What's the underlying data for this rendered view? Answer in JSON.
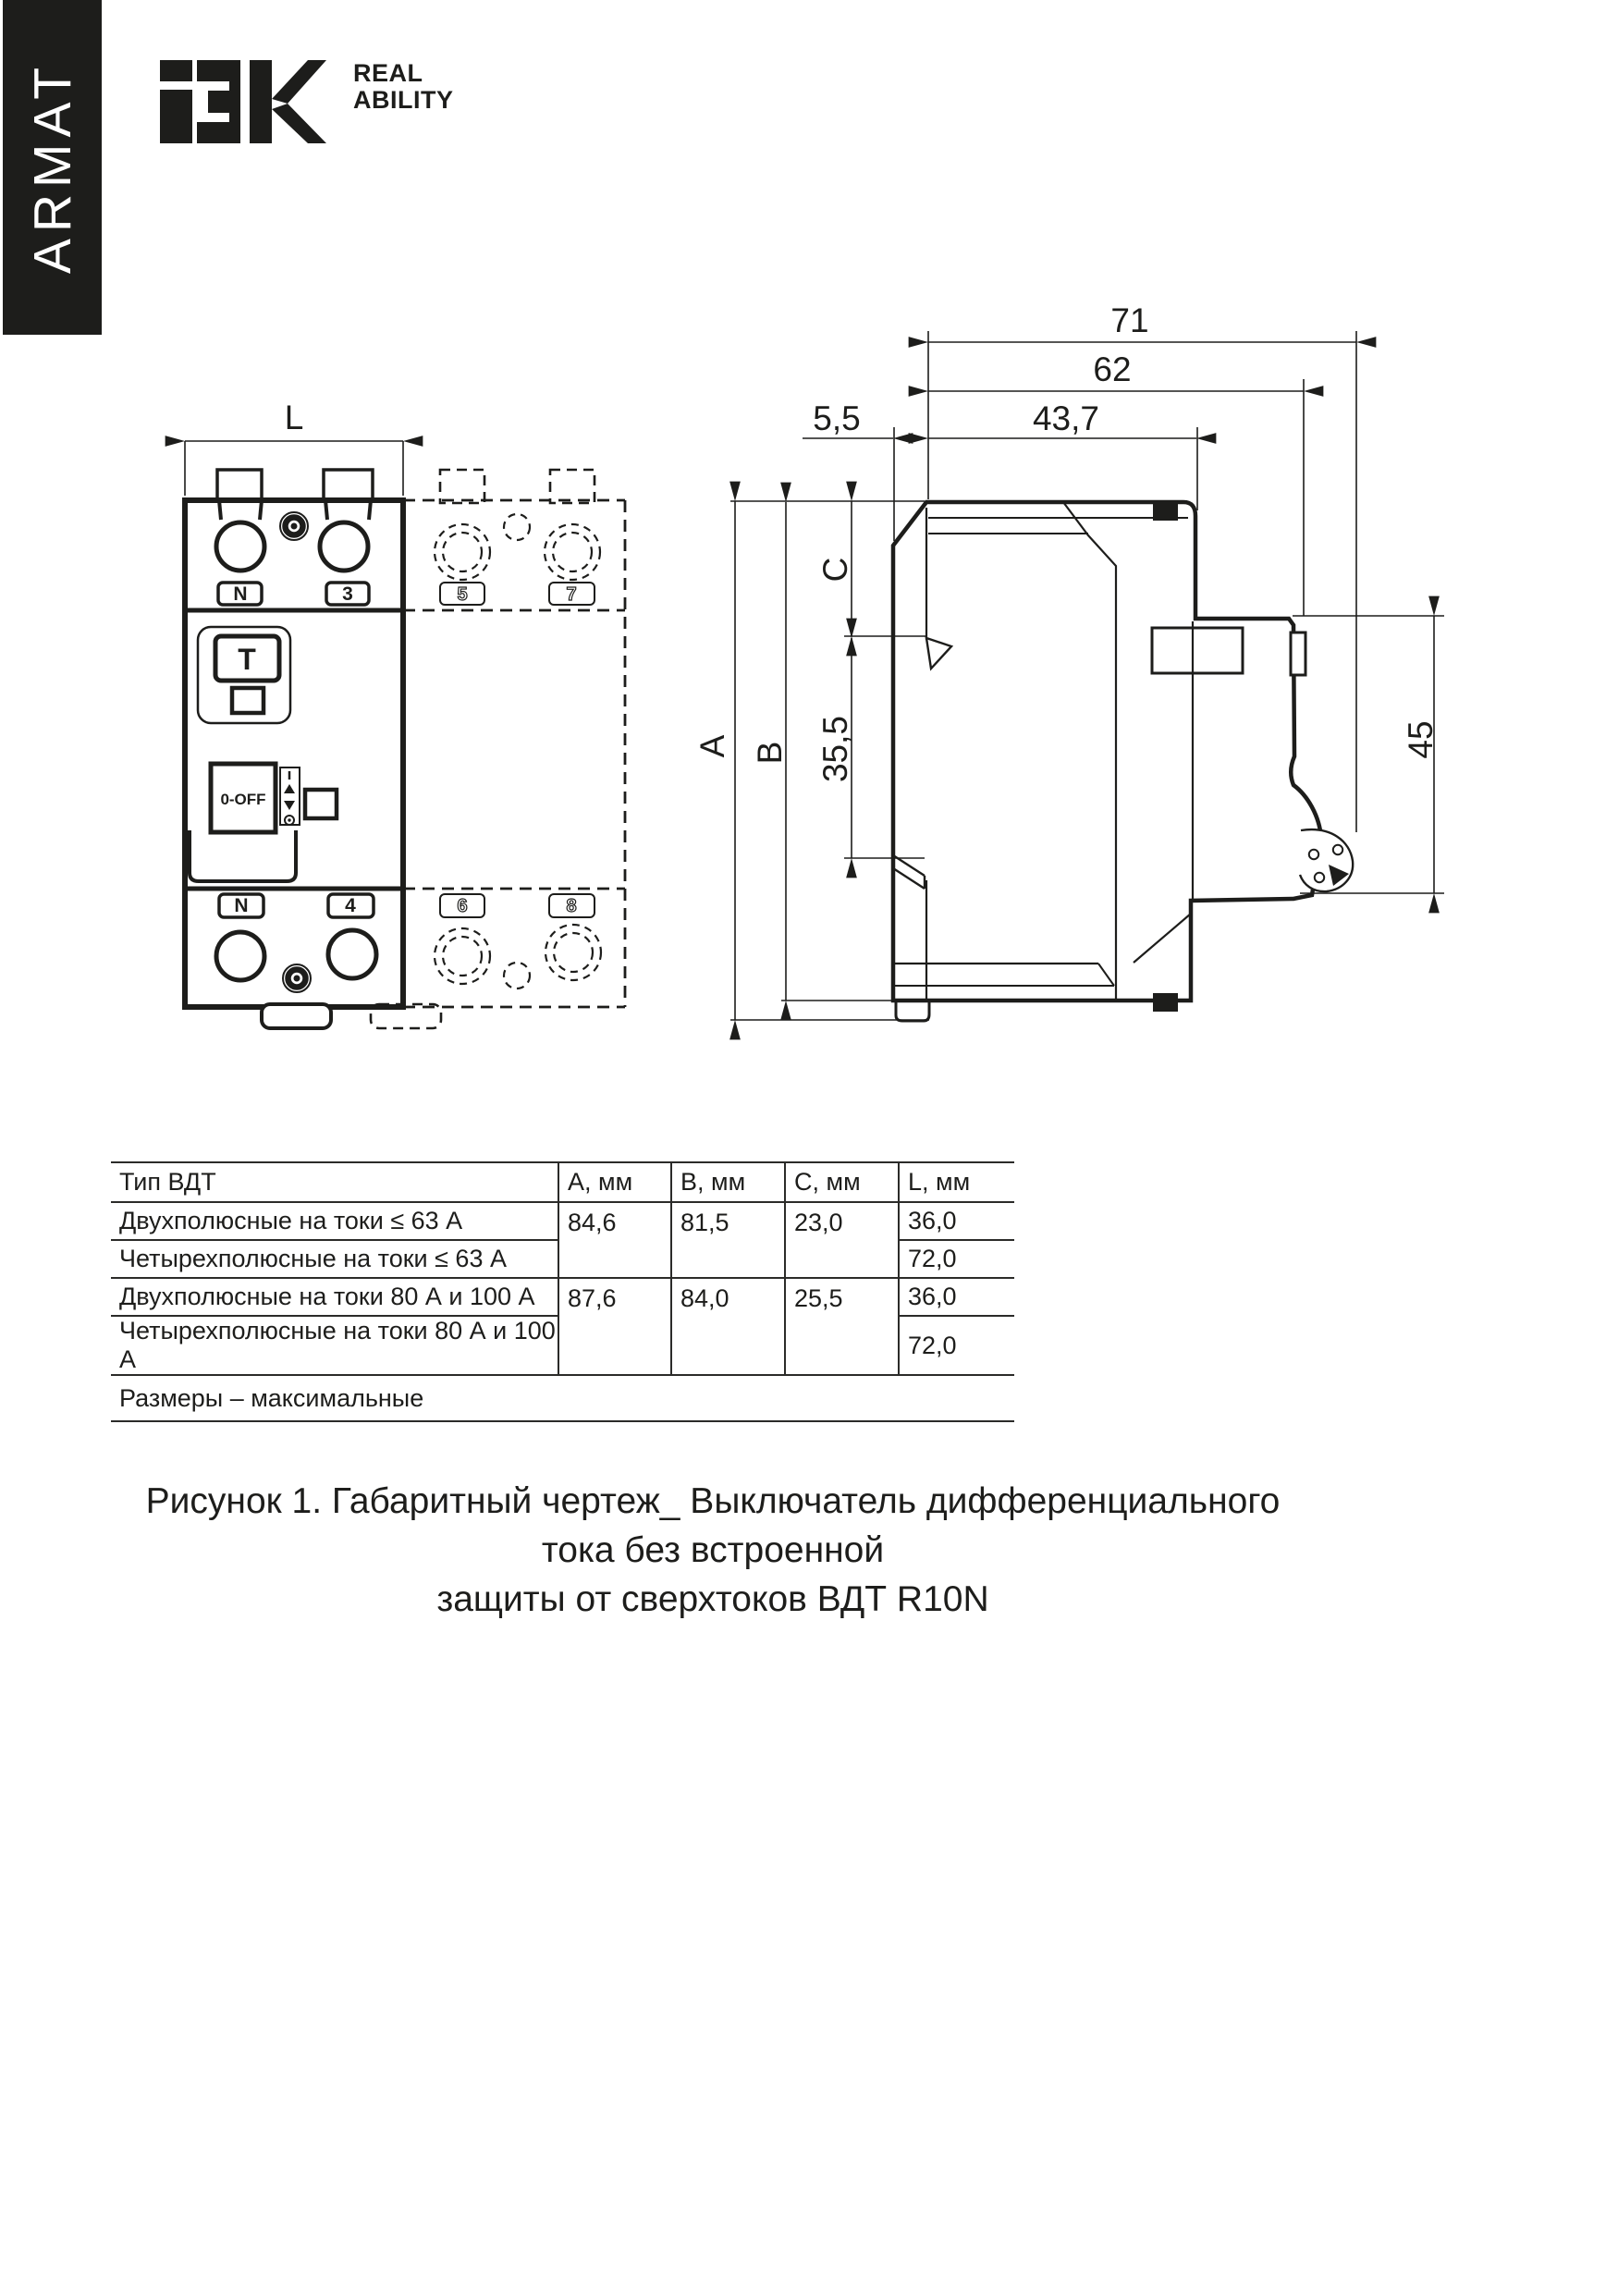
{
  "brand": {
    "sidebar_text": "ARMAT",
    "logo_name": "IEK",
    "tagline_line1": "REAL",
    "tagline_line2": "ABILITY"
  },
  "drawing": {
    "front_view": {
      "dim_width": "L",
      "top_terminal_labels": [
        "N",
        "3",
        "5",
        "7"
      ],
      "bottom_terminal_labels": [
        "N",
        "4",
        "6",
        "8"
      ],
      "test_button_label": "T",
      "switch_label": "0-OFF"
    },
    "side_view": {
      "dim_depth_total": "71",
      "dim_depth_body": "62",
      "dim_rail_offset": "5,5",
      "dim_depth_front": "43,7",
      "dim_height_a": "A",
      "dim_height_b": "B",
      "dim_height_c": "C",
      "dim_rail_channel": "35,5",
      "dim_front_height": "45"
    }
  },
  "table": {
    "headers": [
      "Тип ВДТ",
      "А, мм",
      "В, мм",
      "С, мм",
      "L, мм"
    ],
    "rows": [
      {
        "type": "Двухполюсные на токи ≤ 63 А",
        "a": "84,6",
        "b": "81,5",
        "c": "23,0",
        "l": "36,0"
      },
      {
        "type": "Четырехполюсные на токи ≤ 63 А",
        "l": "72,0"
      },
      {
        "type": "Двухполюсные на токи 80 А и 100 А",
        "a": "87,6",
        "b": "84,0",
        "c": "25,5",
        "l": "36,0"
      },
      {
        "type": "Четырехполюсные на токи 80 А и 100 А",
        "l": "72,0"
      }
    ],
    "footnote": "Размеры – максимальные"
  },
  "caption": {
    "line1": "Рисунок 1. Габаритный чертеж_ Выключатель дифференциального тока без встроенной",
    "line2": "защиты от сверхтоков ВДТ R10N"
  }
}
